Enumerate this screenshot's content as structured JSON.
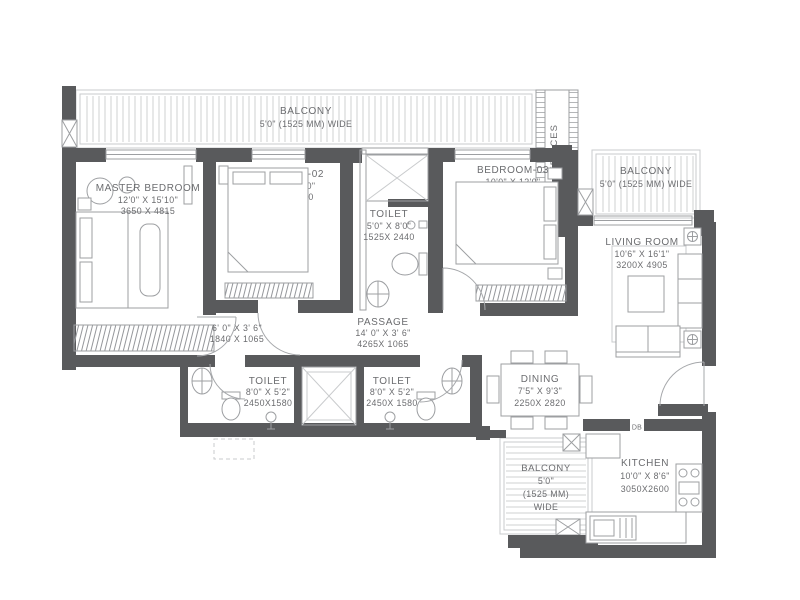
{
  "plan": {
    "colors": {
      "wall": "#595a5c",
      "line": "#9d9fa2",
      "text": "#6b6c6f",
      "hatch": "#d7d8d9"
    },
    "rooms": {
      "balcony_top": {
        "name": "BALCONY",
        "size": "5'0\" (1525 MM) WIDE"
      },
      "services": {
        "name": "SERVICES"
      },
      "master": {
        "name": "MASTER BEDROOM",
        "size_ft": "12'0\" X 15'10\"",
        "size_mm": "3650 X 4815"
      },
      "bedroom2": {
        "name": "BEDROOM-02",
        "size_ft": "10'0\" X 12'0\"",
        "size_mm": "3060X 3650"
      },
      "toilet_top": {
        "name": "TOILET",
        "size_ft": "5'0\" X 8'0\"",
        "size_mm": "1525X 2440"
      },
      "bedroom3": {
        "name": "BEDROOM-03",
        "size_ft": "10'0\" X 12'0\"",
        "size_mm": "3050 X 3650"
      },
      "balcony_right": {
        "name": "BALCONY",
        "size": "5'0\" (1525 MM) WIDE"
      },
      "living": {
        "name": "LIVING ROOM",
        "size_ft": "10'6\" X 16'1\"",
        "size_mm": "3200X 4905"
      },
      "passage_left": {
        "size_ft": "6' 0\" X 3' 6\"",
        "size_mm": "1840 X 1065"
      },
      "passage": {
        "name": "PASSAGE",
        "size_ft": "14' 0\" X 3' 6\"",
        "size_mm": "4265X 1065"
      },
      "toilet_left": {
        "name": "TOILET",
        "size_ft": "8'0\" X 5'2\"",
        "size_mm": "2450X1580"
      },
      "toilet_right": {
        "name": "TOILET",
        "size_ft": "8'0\" X 5'2\"",
        "size_mm": "2450X 1580"
      },
      "dining": {
        "name": "DINING",
        "size_ft": "7'5\" X 9'3\"",
        "size_mm": "2250X 2820"
      },
      "balcony_bottom": {
        "name": "BALCONY",
        "l2": "5'0\"",
        "l3": "(1525 MM)",
        "l4": "WIDE"
      },
      "kitchen": {
        "name": "KITCHEN",
        "size_ft": "10'0\" X 8'6\"",
        "size_mm": "3050X2600"
      },
      "db": {
        "name": "DB"
      }
    }
  }
}
